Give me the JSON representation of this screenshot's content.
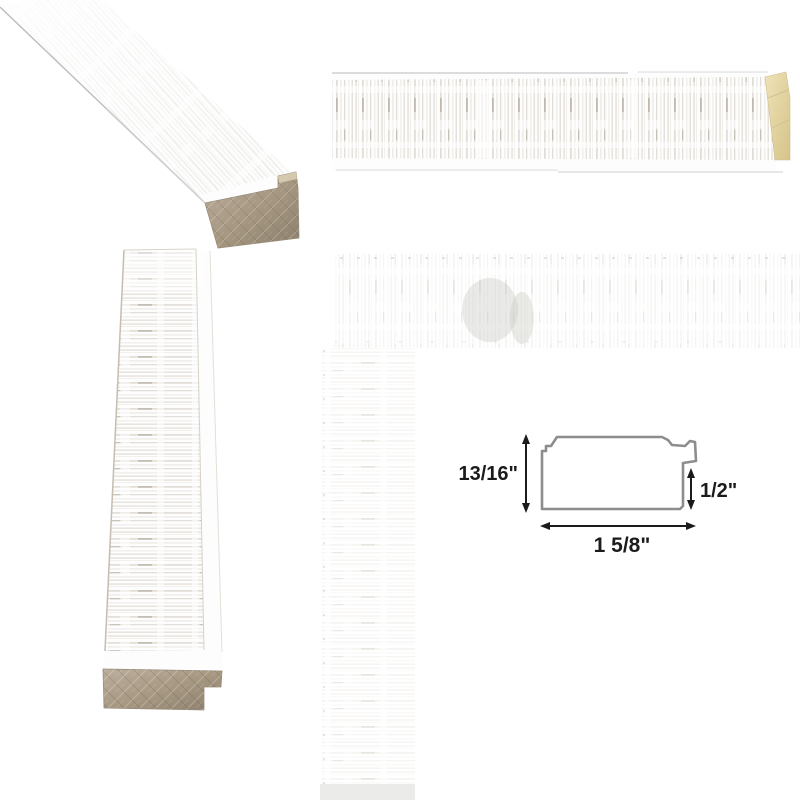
{
  "product": {
    "name": "whitewashed-distressed-picture-frame-moulding",
    "background_color": "#ffffff"
  },
  "views": {
    "corner_angle": {
      "name": "moulding stick angled view with raw wood end cut"
    },
    "strip_horizontal": {
      "name": "moulding length horizontal view with mitered raw wood end"
    },
    "strip_vertical": {
      "name": "moulding length vertical view with raw wood end cut"
    },
    "texture_closeup": {
      "name": "faded close-up of assembled frame corner texture"
    }
  },
  "diagram": {
    "height_label": "13/16\"",
    "rabbet_label": "1/2\"",
    "width_label": "1 5/8\"",
    "outline_color": "#8d8d8d",
    "arrow_color": "#1b1b1b",
    "text_color": "#1b1b1b"
  },
  "colors": {
    "moulding_white": "#fdfdfd",
    "distress_streak": "#b0a48e",
    "raw_wood_taupe": "#a99b89",
    "raw_wood_cream": "#e6d8a8",
    "edge_line": "#c2bcb1"
  }
}
